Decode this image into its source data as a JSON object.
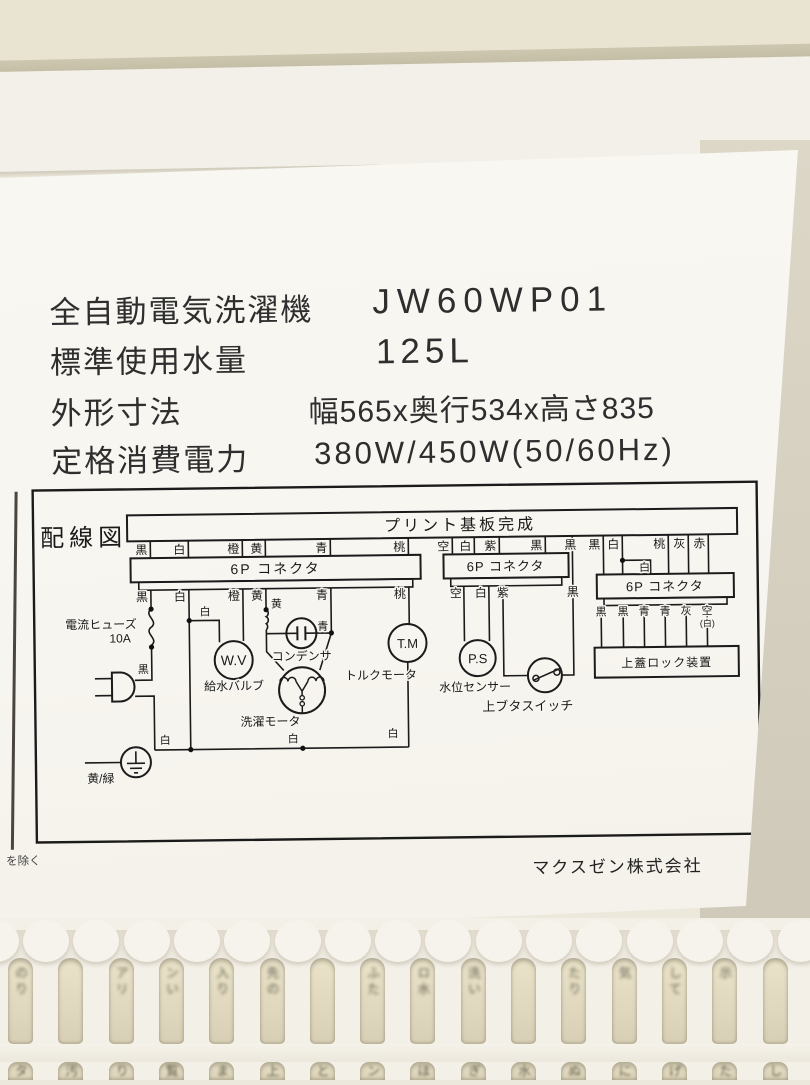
{
  "spec": {
    "rows": [
      {
        "label": "全自動電気洗濯機",
        "value": "JW60WP01"
      },
      {
        "label": "標準使用水量",
        "value": "125L"
      },
      {
        "label": "外形寸法",
        "value": "幅565x奥行534x高さ835"
      },
      {
        "label": "定格消費電力",
        "value": "380W/450W(50/60Hz)"
      }
    ]
  },
  "diagram": {
    "title": "配線図",
    "pcb": "プリント基板完成",
    "conn_label": "6P コネクタ",
    "conn1": {
      "top": [
        "黒",
        "白",
        "橙",
        "黄",
        "青",
        "桃"
      ],
      "bottom": [
        "黒",
        "白",
        "橙",
        "黄",
        "青",
        "桃"
      ]
    },
    "conn2": {
      "top": [
        "空",
        "白",
        "紫",
        "黒"
      ],
      "bottom": [
        "空",
        "白",
        "紫",
        "黒"
      ]
    },
    "conn3": {
      "top": [
        "黒",
        "白",
        "白",
        "桃",
        "灰",
        "赤"
      ],
      "bottom": [
        "黒",
        "黒",
        "青",
        "青",
        "灰",
        "空",
        "(白)"
      ]
    },
    "tags": {
      "shiro": "白",
      "kuro": "黒",
      "ki": "黄",
      "ao": "青"
    },
    "fuse_label": "電流ヒューズ",
    "fuse_rating": "10A",
    "wv": "W.V",
    "wv_label": "給水バルブ",
    "cond": "コンデンサ",
    "motor": "洗濯モータ",
    "tm": "T.M",
    "tm_label": "トルクモータ",
    "ps": "P.S",
    "ps_label": "水位センサー",
    "lid_switch": "上ブタスイッチ",
    "lid_lock": "上蓋ロック装置",
    "ground": "黄/緑"
  },
  "footer": {
    "company": "マクスゼン株式会社",
    "corner": "を除く"
  },
  "grille": {
    "row1": [
      "のり",
      "",
      "アリ",
      "ンい",
      "入り",
      "先の",
      "",
      "ふた",
      "ロ水",
      "洗い",
      "",
      "たり",
      "気",
      "して",
      "示",
      ""
    ],
    "row2": [
      "タ",
      "汚",
      "り",
      "覧",
      "ま",
      "上",
      "と",
      "ン",
      "ほ",
      "ぎ",
      "水",
      "ぬ",
      "に",
      "げ",
      "た",
      "し"
    ]
  },
  "colors": {
    "sticker": "#f8f6f0",
    "body": "#ece8db",
    "ink": "#1b1b1b",
    "slot_paper": "#ded6bc"
  }
}
